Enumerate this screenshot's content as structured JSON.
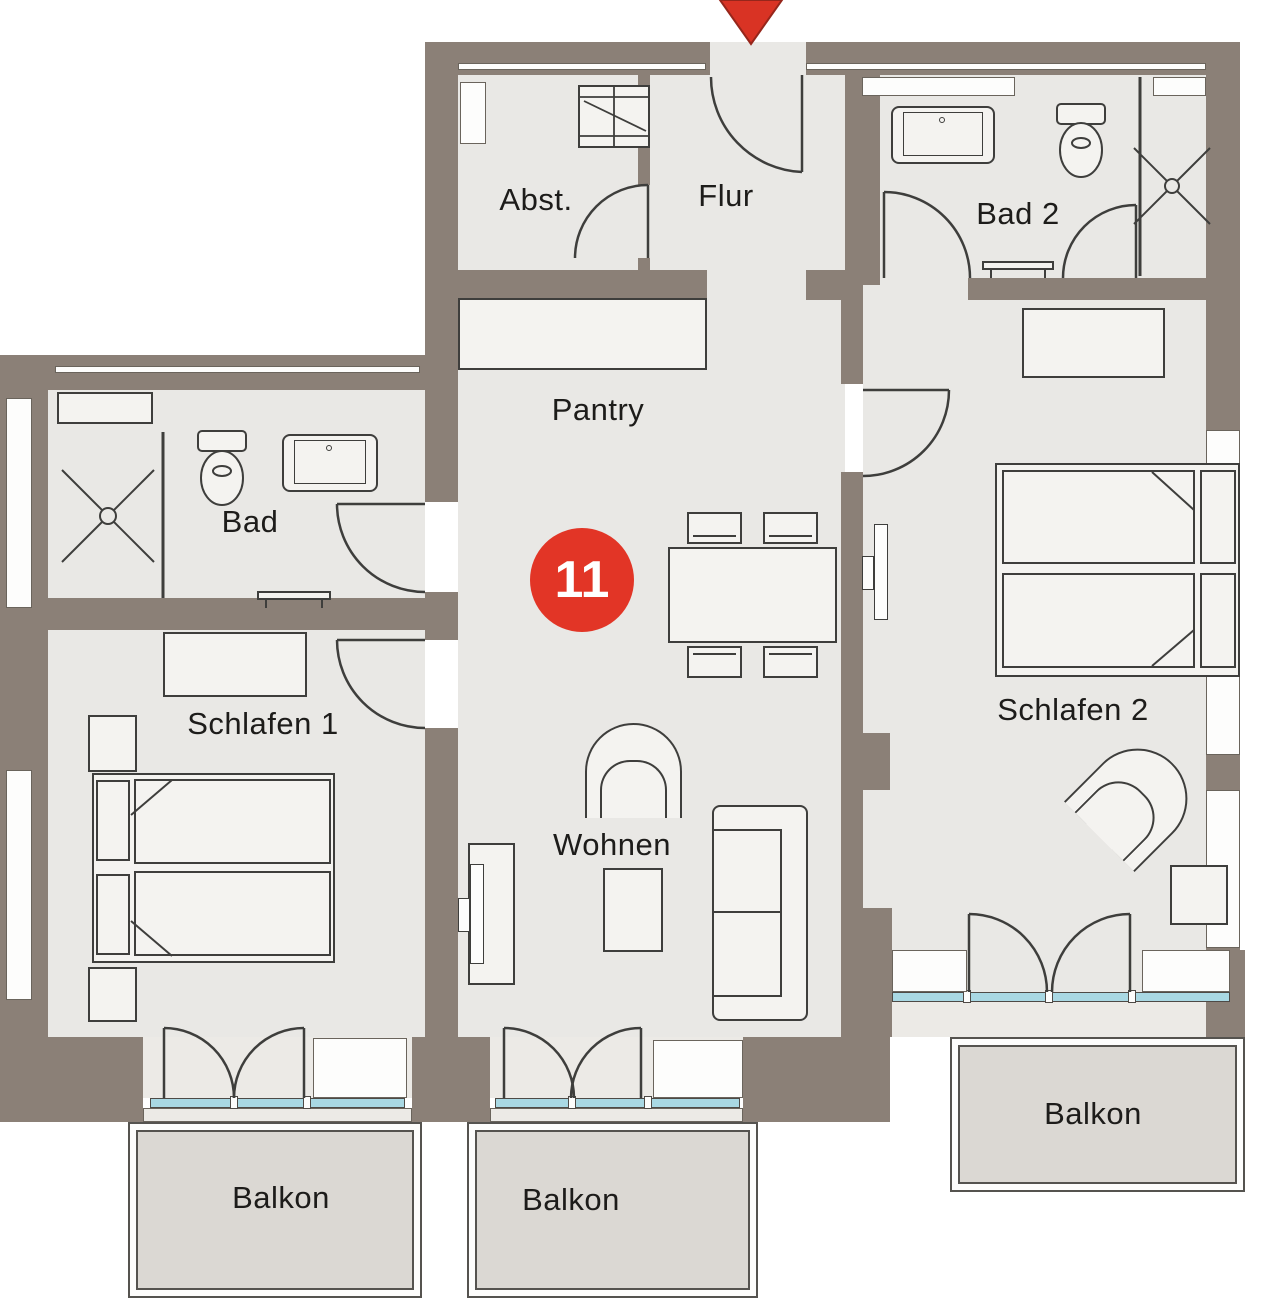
{
  "plan": {
    "unit_number": "11",
    "rooms": [
      {
        "id": "abstellraum",
        "label": "Abst."
      },
      {
        "id": "flur",
        "label": "Flur"
      },
      {
        "id": "bad-2",
        "label": "Bad 2"
      },
      {
        "id": "pantry",
        "label": "Pantry"
      },
      {
        "id": "bad",
        "label": "Bad"
      },
      {
        "id": "schlafen-1",
        "label": "Schlafen 1"
      },
      {
        "id": "wohnen",
        "label": "Wohnen"
      },
      {
        "id": "schlafen-2",
        "label": "Schlafen 2"
      },
      {
        "id": "balkon-schlafen-1",
        "label": "Balkon"
      },
      {
        "id": "balkon-wohnen",
        "label": "Balkon"
      },
      {
        "id": "balkon-schlafen-2",
        "label": "Balkon"
      }
    ],
    "markers": {
      "entrance_arrow": "red-triangle-pointing-down",
      "unit_badge": "red-circle"
    },
    "colors": {
      "wall": "#8b8077",
      "floor": "#e9e8e5",
      "furniture": "#f4f3f0",
      "balcony_floor": "#dbd8d3",
      "window_glass": "#a9d8e3",
      "accent_red": "#e23526",
      "outline": "#3e3e3c"
    }
  }
}
